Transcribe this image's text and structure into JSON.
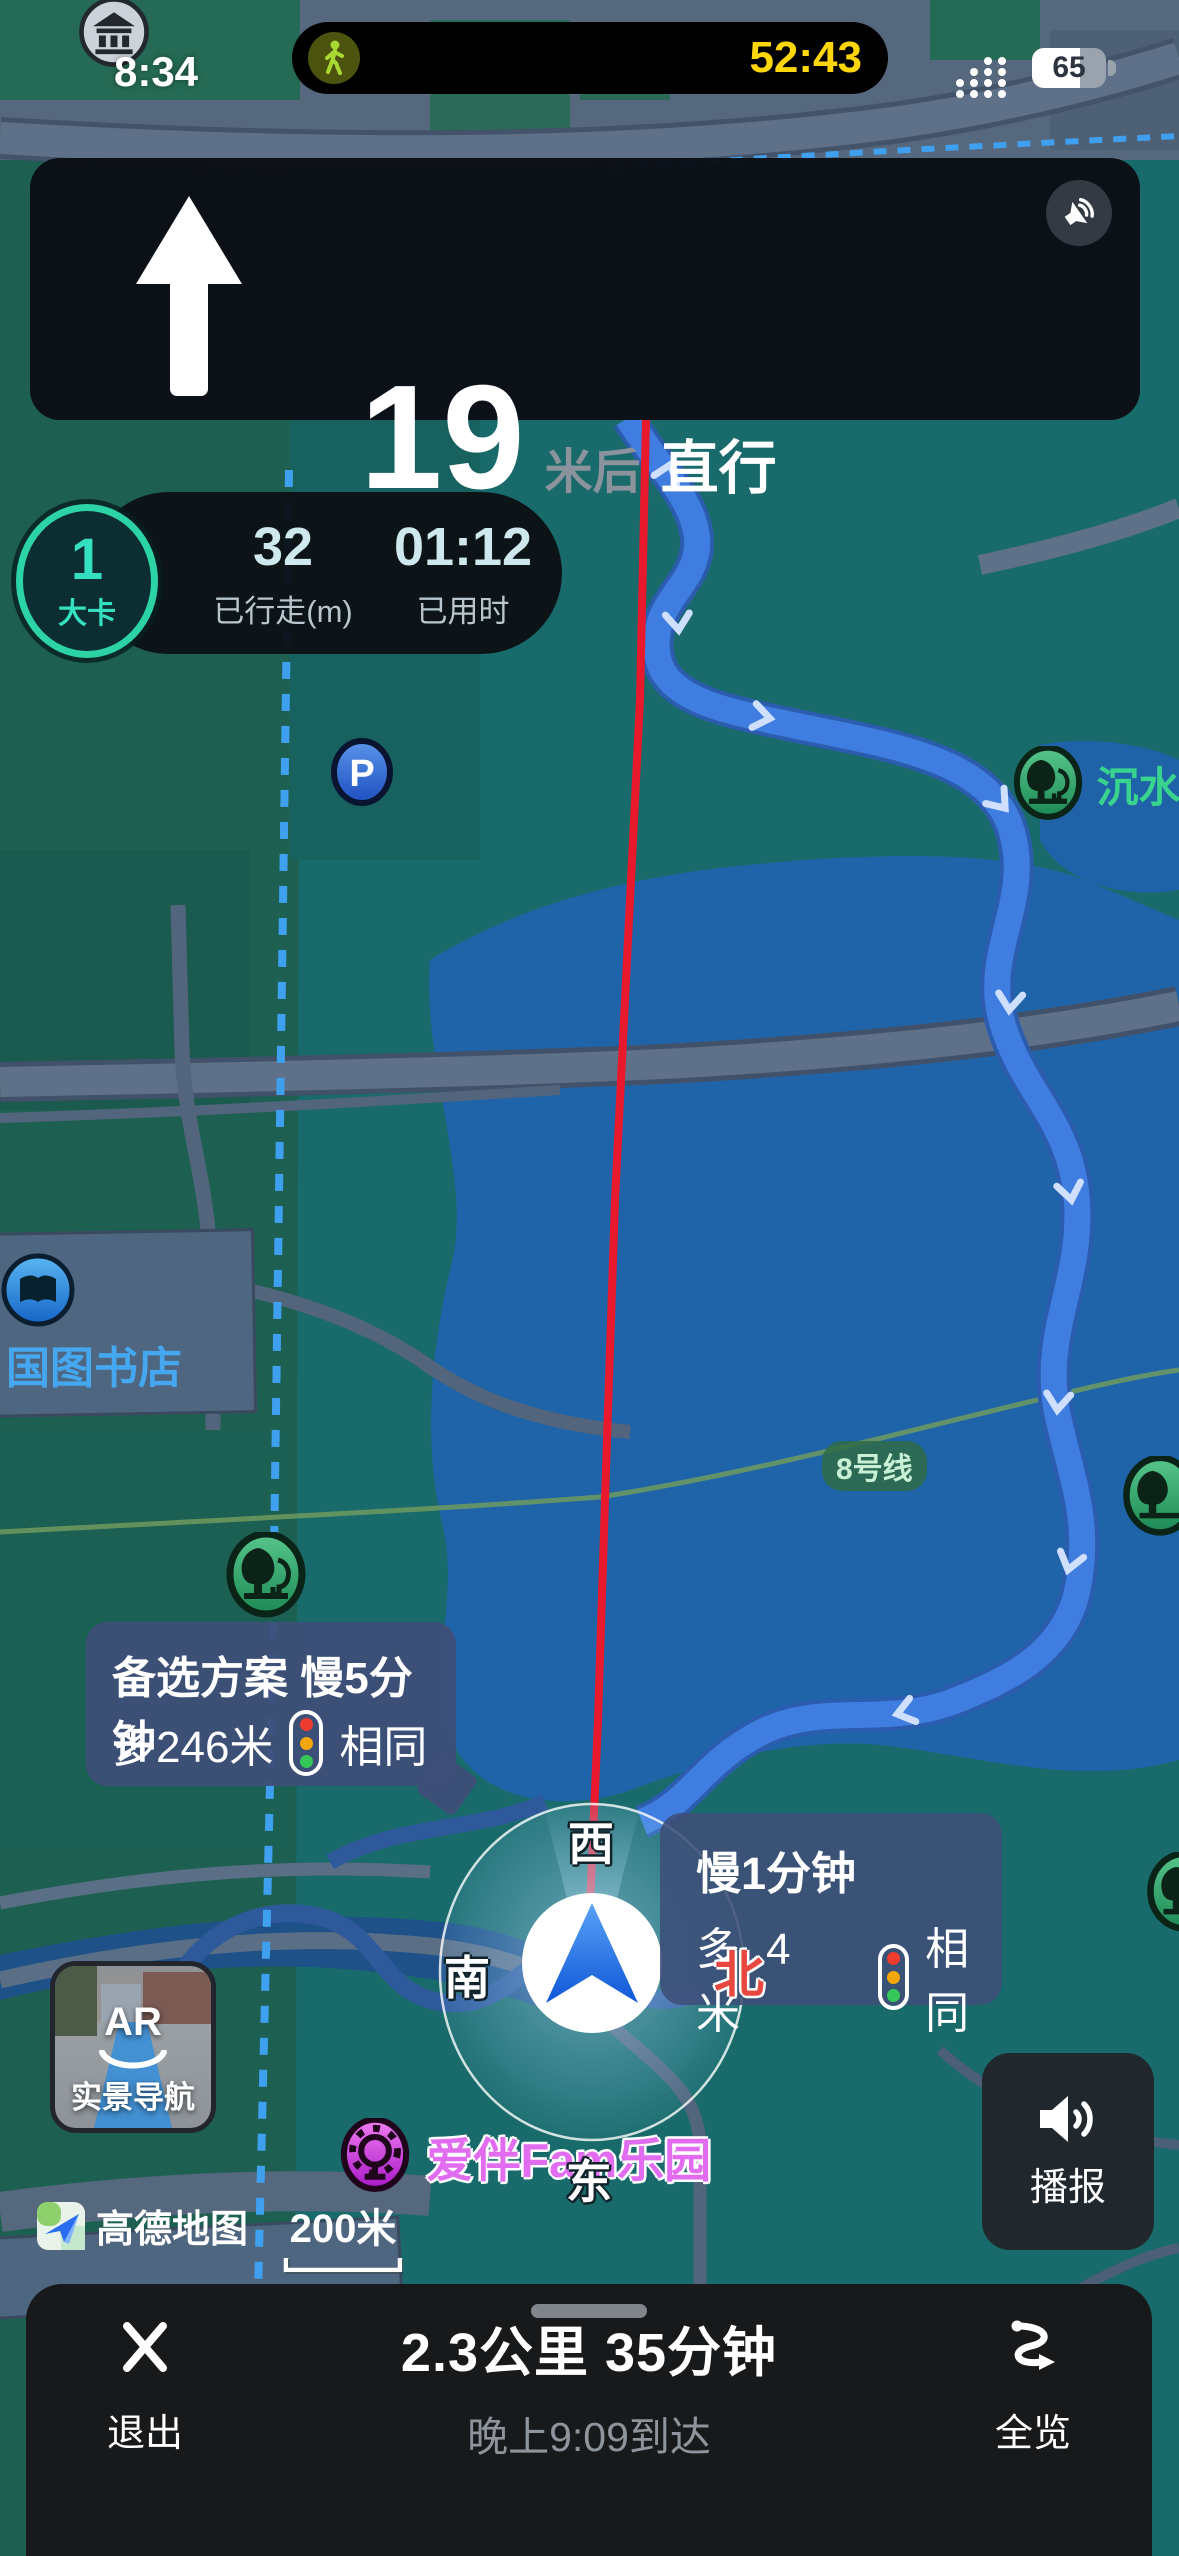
{
  "status_bar": {
    "time": "8:34",
    "battery_percent": "65",
    "island_timer": "52:43"
  },
  "nav_card": {
    "distance_value": "19",
    "distance_suffix": "米后",
    "action": "直行"
  },
  "stats": {
    "calories_value": "1",
    "calories_unit": "大卡",
    "walked_value": "32",
    "walked_label": "已行走(m)",
    "elapsed_value": "01:12",
    "elapsed_label": "已用时"
  },
  "alt_route_main": {
    "headline": "备选方案 慢5分钟",
    "extra_distance": "多246米",
    "lights_note": "相同"
  },
  "alt_route_secondary": {
    "headline": "慢1分钟",
    "extra_distance": "多4米",
    "lights_note": "相同"
  },
  "compass": {
    "north": "北",
    "south": "南",
    "east": "东",
    "west": "西"
  },
  "map_labels": {
    "jiayuan": "佳苑",
    "shanglin": "上林世家",
    "west_top": "西",
    "sudhua_vertical": "速滑",
    "right_edge_partial": "刀",
    "chenshui": "沉水廊",
    "pink_poi_line1": "家国防科技",
    "pink_poi_line2": "业局重大专",
    "pink_poi_line3": "工程中心",
    "kehui_road": "科荟路",
    "tianchen_west_road": "天辰西路",
    "tianchen_east_road": "天辰东路",
    "guotu_bookstore": "国图书店",
    "aosen_greenway_vertical": "奥森公园绿道",
    "longxing_water": "龙形水系",
    "metro_line8": "8号线",
    "olympic_line1": "北京奥林",
    "olympic_line2": "匹克公园",
    "hujing_west_road": "湖景西路",
    "hujing_east_road": "湖景东路",
    "aiban_park": "爱伴Fam乐园",
    "aosen_greenway_small": "奥森公园绿道",
    "huaqin_tower": "华秦大厦"
  },
  "ar_preview": {
    "badge": "AR",
    "label": "实景导航"
  },
  "broadcast_button": {
    "label": "播报"
  },
  "watermark": {
    "brand": "高德地图"
  },
  "scale_bar": {
    "label": "200米"
  },
  "bottom_bar": {
    "exit_label": "退出",
    "summary": "2.3公里  35分钟",
    "eta": "晚上9:09到达",
    "overview_label": "全览"
  },
  "colors": {
    "accent_teal": "#35e0c0",
    "route_red": "#e8192c",
    "timer_yellow": "#ffd60a",
    "bubble_blue": "#3e4f78",
    "trail_blue": "#3f7ee0",
    "lake_blue": "#1f64a8",
    "poi_green": "#38d48e",
    "poi_pink": "#ef5f75",
    "poi_magenta": "#e26cf0"
  }
}
